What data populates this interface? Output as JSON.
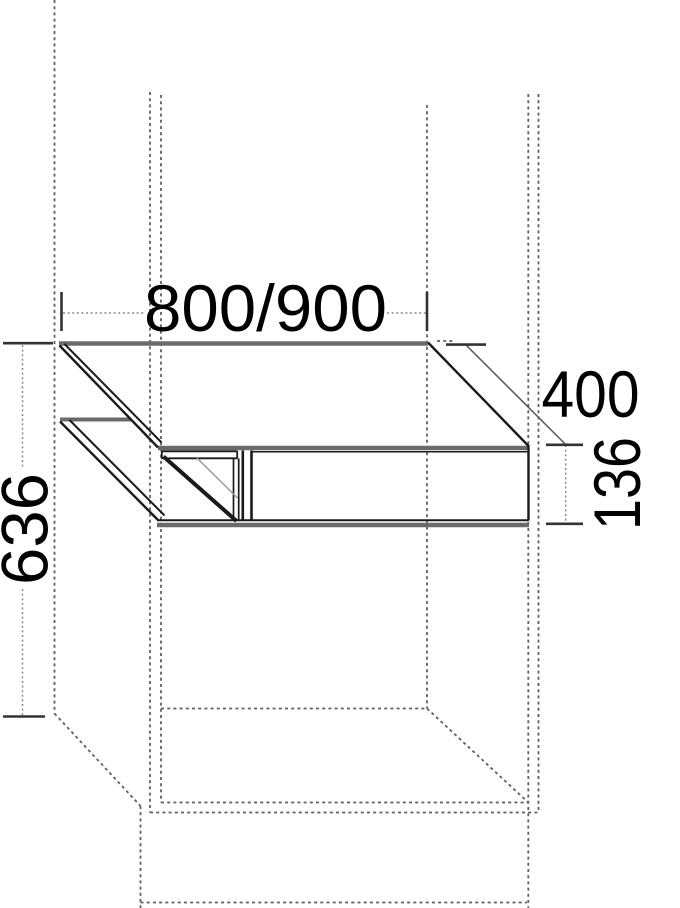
{
  "diagram": {
    "type": "technical-drawing",
    "subject": "niche shelf unit with mounting dimensions",
    "dimensions": {
      "width": {
        "label": "800/900"
      },
      "depth": {
        "label": "400"
      },
      "front_height": {
        "label": "136"
      },
      "niche_height": {
        "label": "636"
      }
    },
    "colors": {
      "background": "#ffffff",
      "solid_line": "#1a1a1a",
      "panel_gray": "#6a6a6a",
      "dashed_gray": "#5f5f5f",
      "dim_line_gray": "#8a8a8a",
      "tick_dark": "#333333",
      "text": "#000000"
    }
  }
}
